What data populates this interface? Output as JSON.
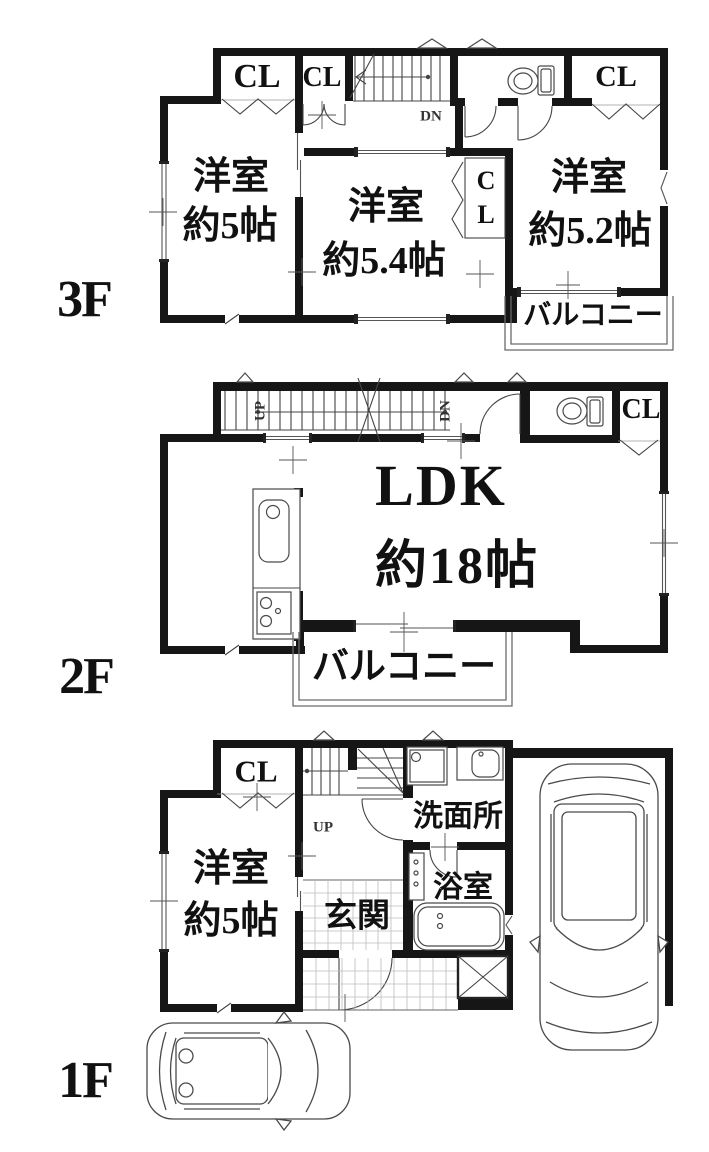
{
  "page": {
    "background": "#ffffff",
    "ink": "#161616"
  },
  "floors": {
    "f3": {
      "label": "3F",
      "closet_left": "CL",
      "closet_mid": "CL",
      "closet_right": "CL",
      "closet_small_top": "C",
      "closet_small_bottom": "L",
      "stairs_down": "DN",
      "room_left_name": "洋室",
      "room_left_size": "約5帖",
      "room_center_name": "洋室",
      "room_center_size": "約5.4帖",
      "room_right_name": "洋室",
      "room_right_size": "約5.2帖",
      "balcony": "バルコニー"
    },
    "f2": {
      "label": "2F",
      "stairs_up": "UP",
      "stairs_down": "DN",
      "ldk_name": "LDK",
      "ldk_size": "約18帖",
      "closet": "CL",
      "balcony": "バルコニー"
    },
    "f1": {
      "label": "1F",
      "closet": "CL",
      "room_name": "洋室",
      "room_size": "約5帖",
      "stairs_up": "UP",
      "washroom": "洗面所",
      "bathroom": "浴室",
      "entrance": "玄関"
    }
  }
}
